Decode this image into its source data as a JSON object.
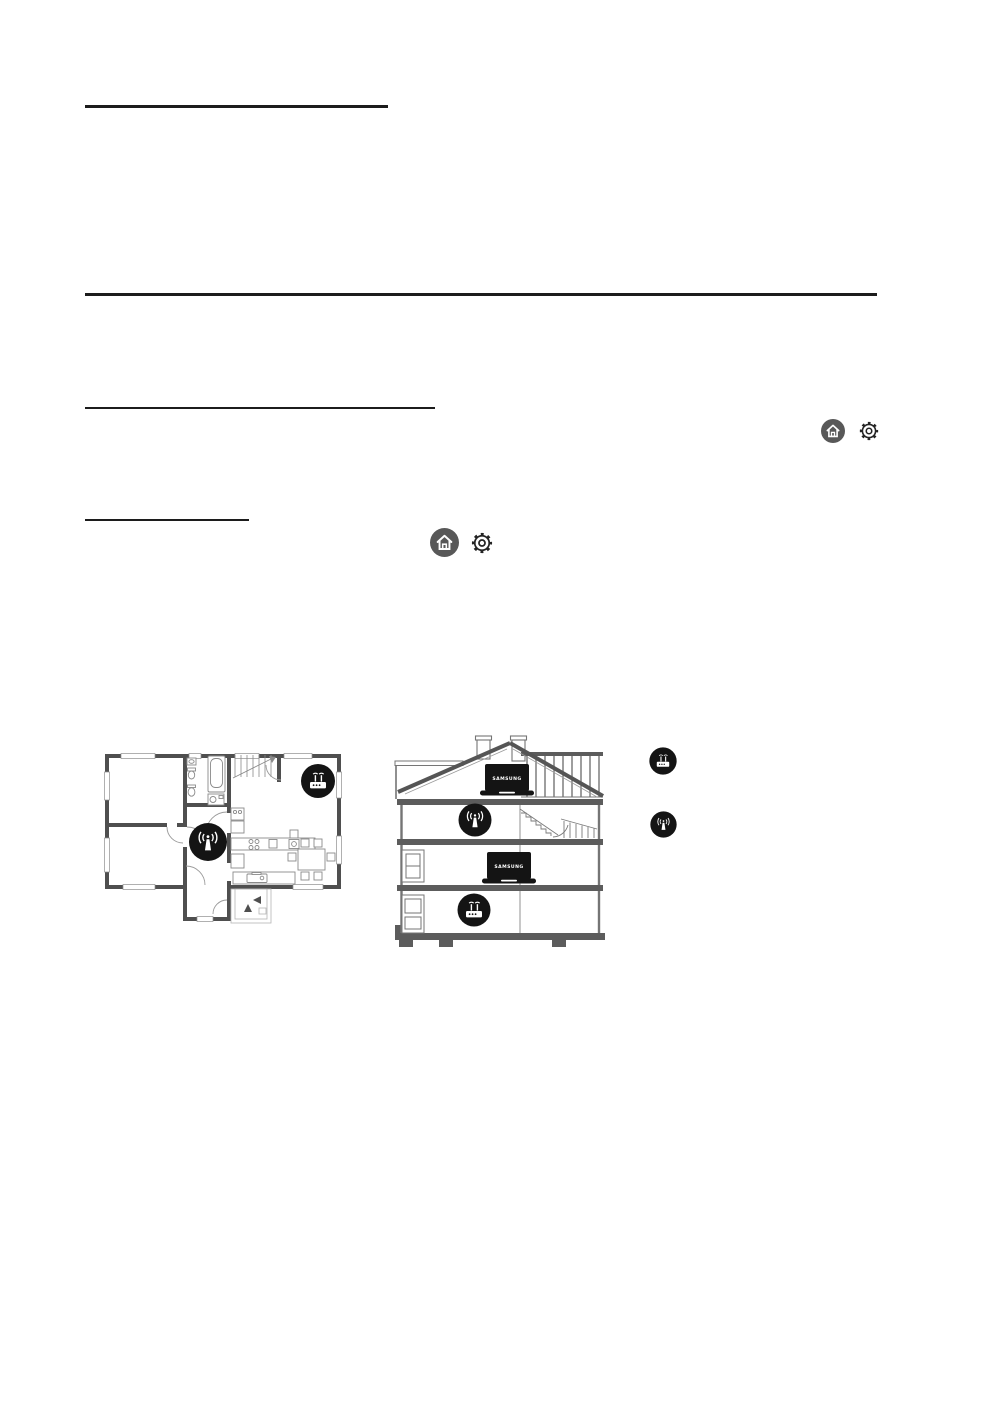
{
  "page": {
    "background": "#ffffff",
    "rule_color": "#1c1c1c"
  },
  "inline_ui_icons": {
    "home_button": {
      "icon": "home-icon",
      "circle_color": "#585858",
      "glyph_color": "#ffffff"
    },
    "settings_button": {
      "icon": "gear-icon",
      "color": "#242424"
    }
  },
  "floor_plan": {
    "wall_color": "#4f4f4f",
    "fixture_color": "#8a8a8a",
    "badge_color": "#141414",
    "router_badge_icon": "wifi-router-icon",
    "extender_badge_icon": "wifi-extender-icon"
  },
  "cross_section": {
    "laptop_label": "SAMSUNG",
    "frame_color": "#757575",
    "slab_color": "#5c5c5c",
    "badge_color": "#141414",
    "extender_badge_icon": "wifi-extender-icon",
    "router_badge_icon": "wifi-router-icon"
  },
  "legend": {
    "badge_color": "#141414",
    "router_icon": "wifi-router-icon",
    "extender_icon": "wifi-extender-icon"
  }
}
